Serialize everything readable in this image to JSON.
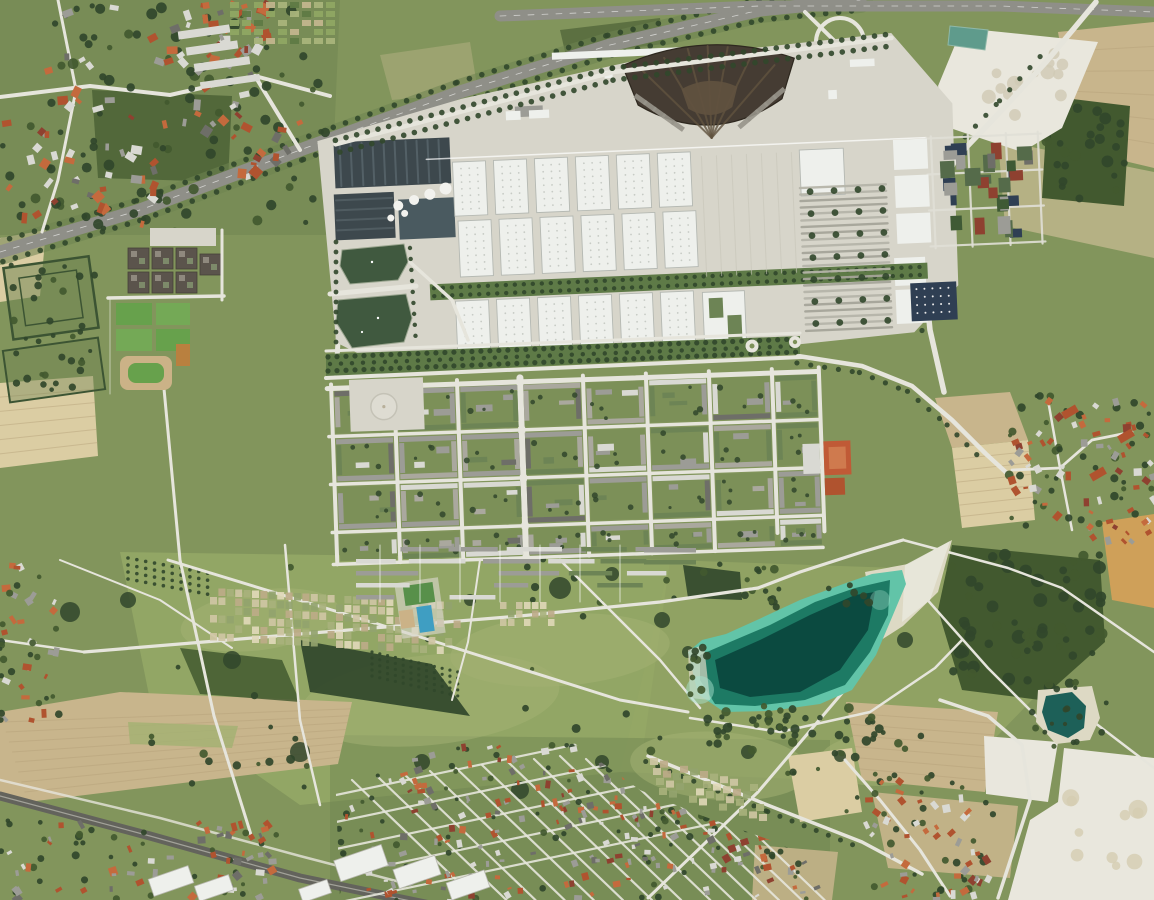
{
  "image": {
    "kind": "aerial-orthophoto",
    "width": 1154,
    "height": 900,
    "depicts": "aerial view of a trade-fair and residential district with exhibition halls, a fan-shaped hall, a landscaped park, a turquoise bathing lake, surrounding farm fields, villages and motorways"
  },
  "features": [
    "suburb-northwest",
    "allotment-gardens",
    "motorway-a94",
    "motorway-top",
    "interchange",
    "trade-fair-grounds",
    "fan-building",
    "congress-centre",
    "exhibition-halls",
    "north-service-buildings",
    "east-apron",
    "east-parking",
    "commercial-east",
    "promenade",
    "residential-district",
    "circular-plaza",
    "ornamental-ponds",
    "shopping-blocks",
    "sports-fields",
    "school-sports",
    "riemer-park",
    "park-paths",
    "garden-plots",
    "leisure-courts",
    "bathing-lake",
    "beach",
    "quarry-pond",
    "gravel-works",
    "farm-fields",
    "woods",
    "village-east",
    "suburb-south",
    "suburb-southwest",
    "village-southeast",
    "industrial-south",
    "railway-line"
  ],
  "palette": {
    "grass_base": "#82955c",
    "meadow_light": "#94a766",
    "meadow_pale": "#a3b172",
    "grass_dark": "#6d8350",
    "tree_dark": "#31472b",
    "tree_mid": "#42592f",
    "hedge": "#3c5433",
    "field_tan": "#c8b58c",
    "field_pale": "#dbcda3",
    "field_gold": "#cfa059",
    "field_green_tan": "#b5b184",
    "field_stripe": "#b3a078",
    "gravel_white": "#e9e7dd",
    "sand_beach": "#ddd9c4",
    "concrete": "#d7d5ca",
    "road_light": "#e6e5dc",
    "road_gray": "#a8a8a0",
    "asphalt_dark": "#8f8f88",
    "rail_dark": "#63635c",
    "hall_white": "#eef0ec",
    "hall_edge": "#b4b8b2",
    "hall_dot": "#c7cbc5",
    "fan_dark": "#453c33",
    "fan_mid": "#60523f",
    "fan_light": "#97938a",
    "congress_dark": "#3d484d",
    "congress_light": "#5d6b70",
    "roof_red": "#b0532f",
    "roof_orange": "#c46a3d",
    "roof_darkred": "#8e4130",
    "roof_gray": "#9c9c96",
    "roof_white": "#d9d9d3",
    "roof_darkgray": "#6e6e68",
    "roof_green": "#6d8455",
    "roof_navy": "#2f3f53",
    "lake_deep": "#0b4a40",
    "lake_mid": "#1d7a64",
    "lake_shallow": "#62c4a8",
    "lake_pale": "#a5e0cc",
    "pond_green": "#40593f",
    "pond_teal": "#1d6058",
    "pond_small": "#5f9b8c",
    "pool_blue": "#3f9ec2",
    "pitch_green": "#67a14c",
    "pitch_green2": "#74a956",
    "track_red": "#c05a36",
    "court_tan": "#cbb287",
    "courtyard": "#7c9058",
    "plaza": "#dedcd2"
  }
}
